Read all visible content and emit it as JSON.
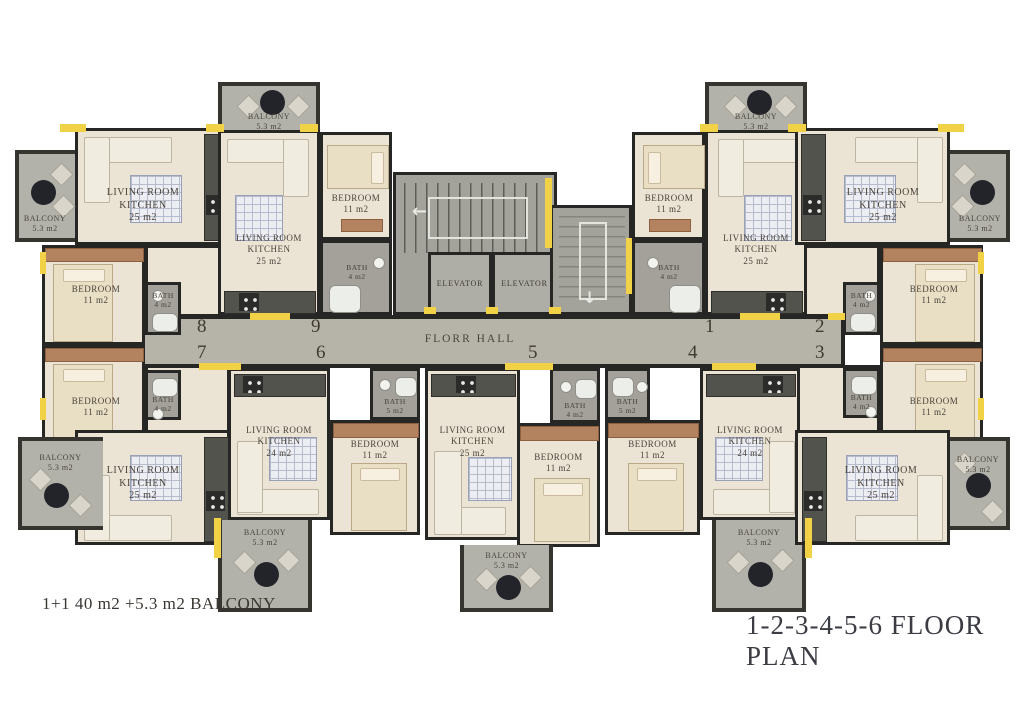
{
  "title": "1-2-3-4-5-6 FLOOR PLAN",
  "legend": "1+1 40 m2 +5.3 m2 BALCONY",
  "hall": {
    "label": "FLORR HALL"
  },
  "core": {
    "elevators": [
      "ELEVATOR",
      "ELEVATOR"
    ]
  },
  "units": [
    {
      "number": "1",
      "living_room": "LIVING ROOM\nKITCHEN\n25 m2",
      "bedroom": "BEDROOM\n11 m2",
      "bath": "BATH\n4 m2",
      "balcony": "BALCONY\n5.3 m2"
    },
    {
      "number": "2",
      "living_room": "LIVING ROOM\nKITCHEN\n25 m2",
      "bedroom": "BEDROOM\n11 m2",
      "bath": "BATH\n4 m2",
      "balcony": "BALCONY\n5.3 m2"
    },
    {
      "number": "3",
      "living_room": "LIVING ROOM\nKITCHEN\n25 m2",
      "bedroom": "BEDROOM\n11 m2",
      "bath": "BATH\n4 m2",
      "balcony": "BALCONY\n5.3 m2"
    },
    {
      "number": "4",
      "living_room": "LIVING ROOM\nKITCHEN\n24 m2",
      "bedroom": "BEDROOM\n11 m2",
      "bath": "BATH\n5 m2",
      "balcony": "BALCONY\n5.3 m2"
    },
    {
      "number": "5",
      "living_room": "LIVING ROOM\nKITCHEN\n25 m2",
      "bedroom": "BEDROOM\n11 m2",
      "bath": "BATH\n4 m2",
      "balcony": "BALCONY\n5.3 m2"
    },
    {
      "number": "6",
      "living_room": "LIVING ROOM\nKITCHEN\n24 m2",
      "bedroom": "BEDROOM\n11 m2",
      "bath": "BATH\n5 m2",
      "balcony": "BALCONY\n5.3 m2"
    },
    {
      "number": "7",
      "living_room": "LIVING ROOM\nKITCHEN\n25 m2",
      "bedroom": "BEDROOM\n11 m2",
      "bath": "BATH\n4 m2",
      "balcony": "BALCONY\n5.3 m2"
    },
    {
      "number": "8",
      "living_room": "LIVING ROOM\nKITCHEN\n25 m2",
      "bedroom": "BEDROOM\n11 m2",
      "bath": "BATH\n4 m2",
      "balcony": "BALCONY\n5.3 m2"
    },
    {
      "number": "9",
      "living_room": "LIVING ROOM\nKITCHEN\n25 m2",
      "bedroom": "BEDROOM\n11 m2",
      "bath": "BATH\n4 m2",
      "balcony": "BALCONY\n5.3 m2"
    }
  ],
  "colors": {
    "accent_yellow": "#f1d246",
    "wall": "#262624",
    "apartment_floor": "#ebe4d5",
    "balcony_floor": "#b2b2aa",
    "hall_floor": "#b6b3a8",
    "core_floor": "#a3a39c"
  }
}
